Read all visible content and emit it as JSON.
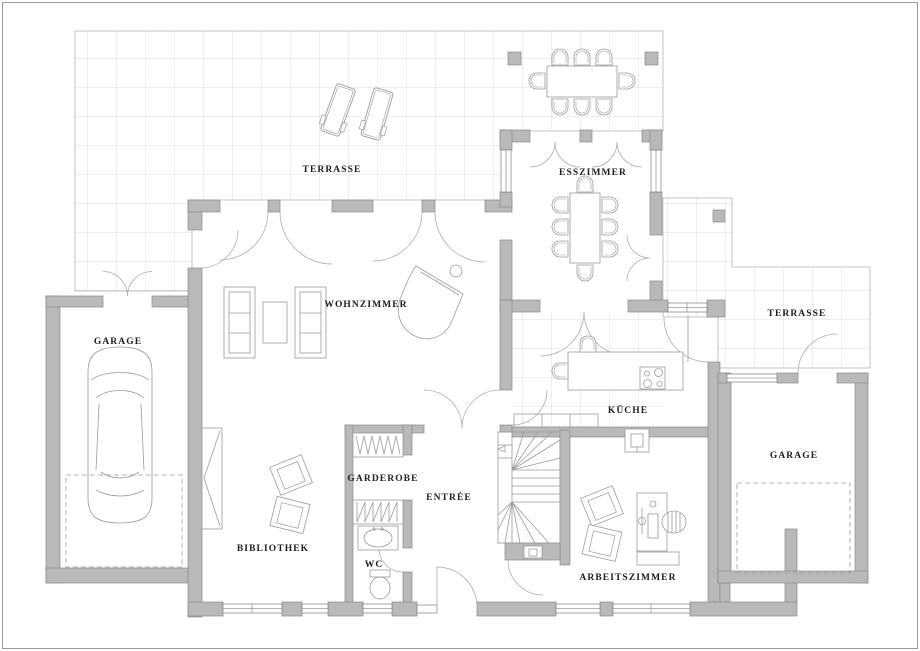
{
  "plan": {
    "type": "architectural-floor-plan",
    "floor": "ground-floor",
    "language": "German"
  },
  "colors": {
    "wall": "#b9b9b9",
    "wall_outline": "#8a8a8a",
    "line": "#9a9a9a",
    "tile_grid": "#d4d4d4",
    "label": "#1c1c1c",
    "background": "#ffffff"
  },
  "rooms": [
    {
      "id": "terrasse-top",
      "label": "TERRASSE"
    },
    {
      "id": "esszimmer",
      "label": "ESSZIMMER"
    },
    {
      "id": "terrasse-right",
      "label": "TERRASSE"
    },
    {
      "id": "wohnzimmer",
      "label": "WOHNZIMMER"
    },
    {
      "id": "garage-left",
      "label": "GARAGE"
    },
    {
      "id": "kueche",
      "label": "KÜCHE"
    },
    {
      "id": "garage-right",
      "label": "GARAGE"
    },
    {
      "id": "garderobe",
      "label": "GARDEROBE"
    },
    {
      "id": "entree",
      "label": "ENTRÉE"
    },
    {
      "id": "bibliothek",
      "label": "BIBLIOTHEK"
    },
    {
      "id": "wc",
      "label": "WC"
    },
    {
      "id": "arbeitszimmer",
      "label": "ARBEITSZIMMER"
    }
  ]
}
